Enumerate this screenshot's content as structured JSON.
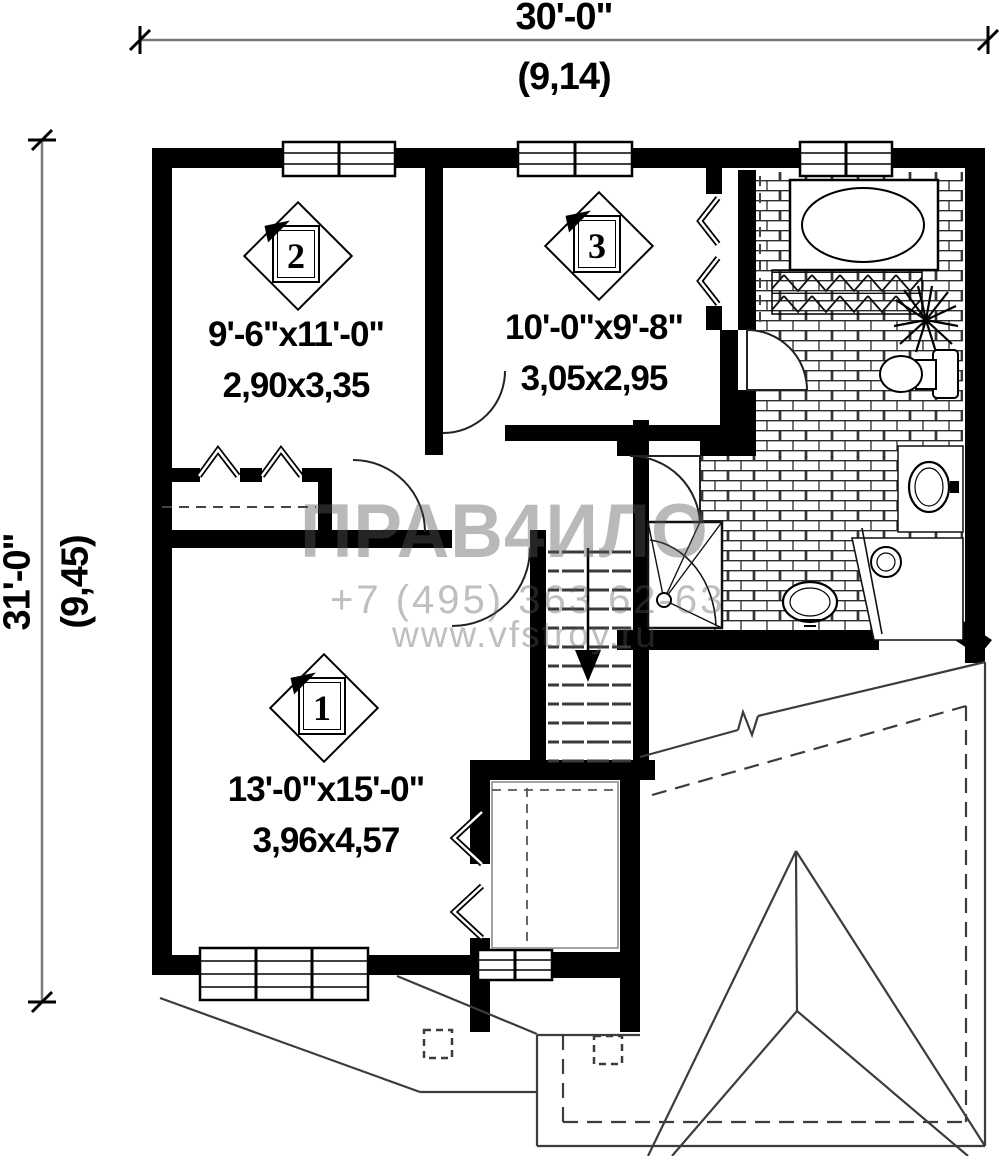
{
  "colors": {
    "wall": "#000000",
    "thin_line": "#333333",
    "dimension_line": "#7a7a7a",
    "watermark_gray": "#8f8f8f",
    "background": "#ffffff"
  },
  "dimensions": {
    "top": {
      "feet": "30'-0\"",
      "meters": "(9,14)"
    },
    "left": {
      "feet": "31'-0\"",
      "meters": "(9,45)"
    }
  },
  "rooms": [
    {
      "number": "2",
      "size_imperial": "9'-6\"x11'-0\"",
      "size_metric": "2,90x3,35"
    },
    {
      "number": "3",
      "size_imperial": "10'-0\"x9'-8\"",
      "size_metric": "3,05x2,95"
    },
    {
      "number": "1",
      "size_imperial": "13'-0\"x15'-0\"",
      "size_metric": "3,96x4,57"
    }
  ],
  "watermark": {
    "brand": "ПРАВ4ИЛО",
    "phone": "+7 (495) 363 62-63",
    "website": "www.vfstroy.ru"
  }
}
